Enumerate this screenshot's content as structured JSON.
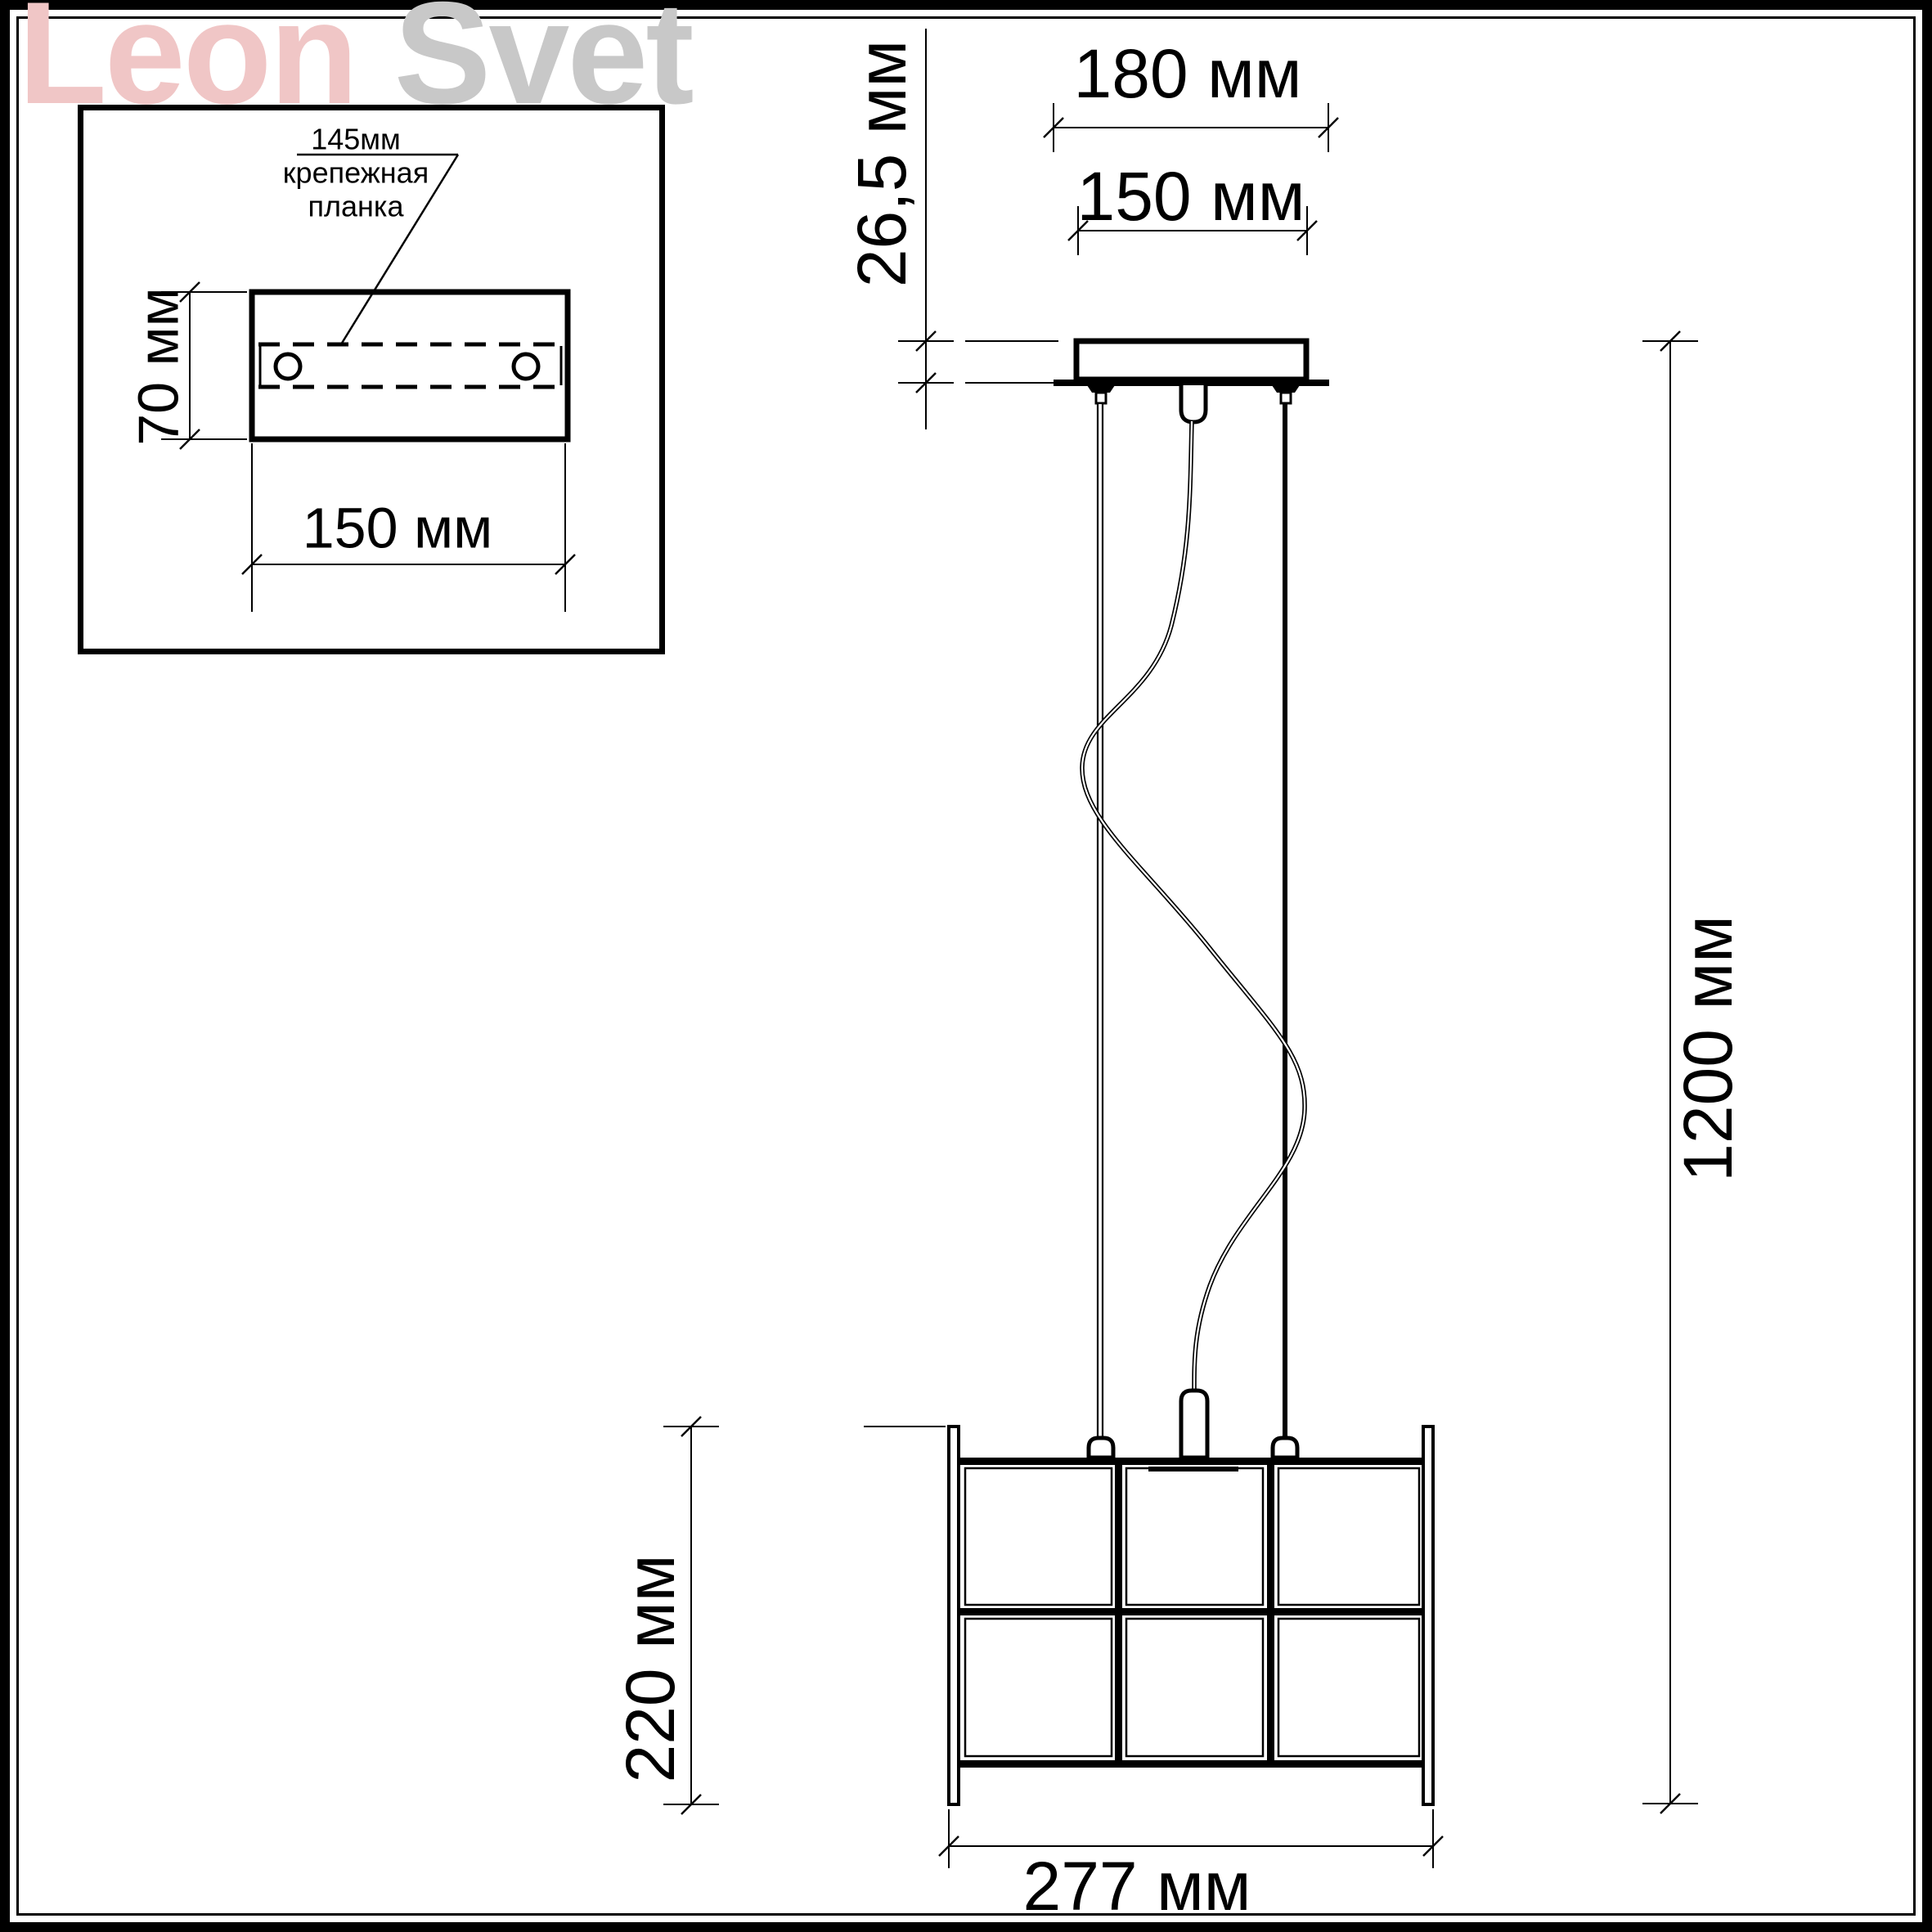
{
  "logo": {
    "word1": "Leon",
    "word2": "Svet",
    "word1_color": "#f0c6c6",
    "word2_color": "#c8c8c8"
  },
  "inset_view": {
    "leader_label_line1": "145мм",
    "leader_label_line2": "крепежная",
    "leader_label_line3": "планка",
    "plate_height": "70 мм",
    "plate_width": "150 мм"
  },
  "main_view": {
    "canopy_plate_width": "180 мм",
    "canopy_body_width": "150 мм",
    "canopy_height": "26,5 мм",
    "suspension_length": "1200 мм",
    "shade_height": "220 мм",
    "shade_width": "277 мм"
  },
  "colors": {
    "line": "#000000",
    "background": "#ffffff"
  }
}
